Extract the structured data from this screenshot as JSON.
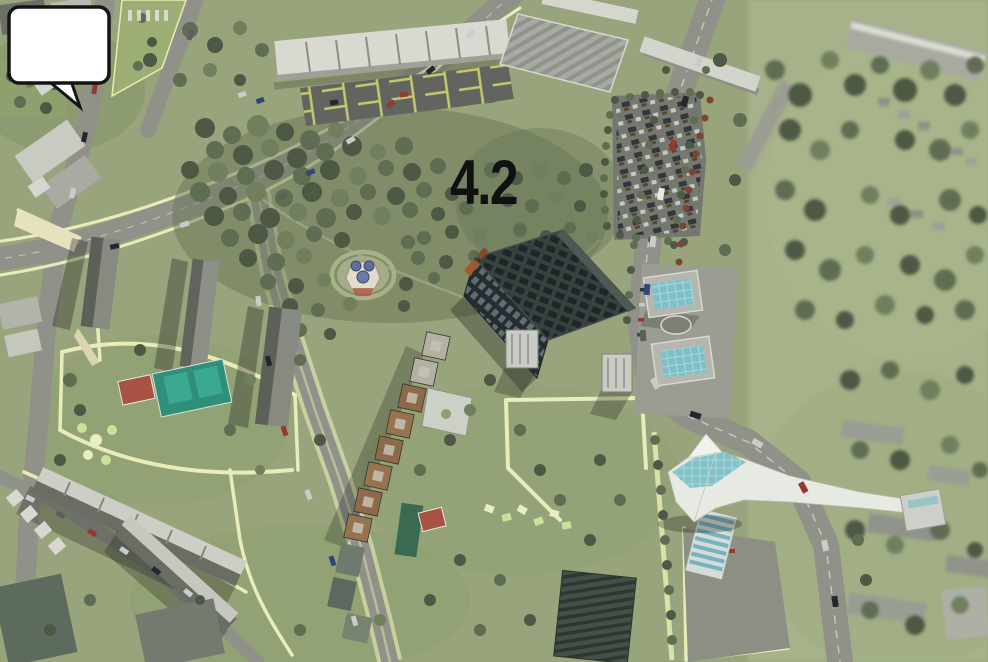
{
  "scene": {
    "description": "aerial 3d render of residential district with numbered building callout",
    "marker": {
      "label": "4.2"
    }
  },
  "palette": {
    "grass": "#98a47b",
    "grass_light": "#a6b289",
    "road": "#90928a",
    "path_yellow": "#edf1bd",
    "tree_dark": "#4d5945",
    "tree_mid": "#5f6d52",
    "tree_light": "#70805f",
    "building_white": "#d7d8d0",
    "building_side": "#84867e",
    "building_dark": "#2a3134",
    "brown_tower": "#8c6a4a",
    "teal_glass": "#7fc0c8",
    "court_red": "#a85243",
    "court_green": "#2f8f7a",
    "marker_bg": "#ffffff",
    "marker_border": "#141414",
    "marker_text": "#111111"
  }
}
